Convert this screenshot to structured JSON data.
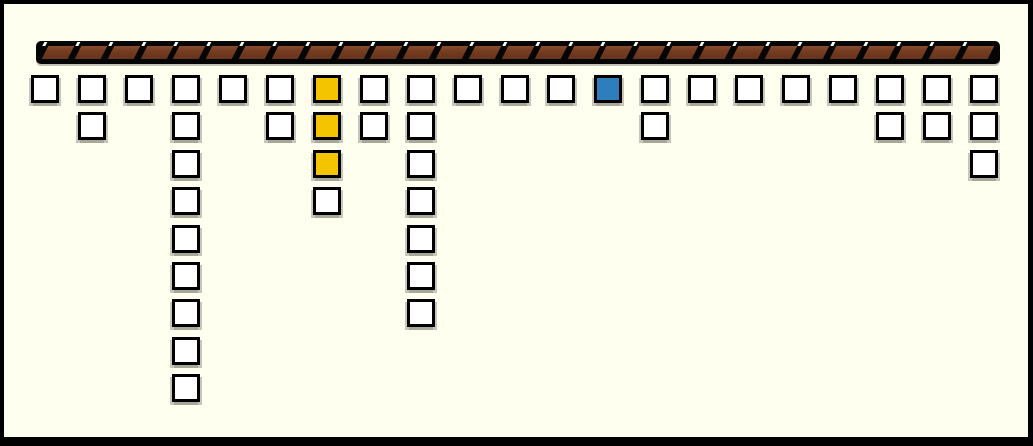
{
  "scene": {
    "background_color": "#FFFFF0",
    "frame_color": "#000000",
    "frame_border": {
      "top": 4,
      "left": 4,
      "right": 5,
      "bottom": 9
    }
  },
  "rail": {
    "segment_count": 29,
    "fill_color": "#743C20",
    "highlight_color": "#8A4C2B",
    "shadow_color": "#66341C",
    "outline_color": "#000000",
    "tick_color": "#FFFFF0"
  },
  "grid": {
    "tile_border_color": "#000000",
    "colors": {
      "white": "#FFFFFF",
      "yellow": "#F5C400",
      "blue": "#2E7EBE"
    },
    "columns": [
      {
        "cells": [
          "white"
        ]
      },
      {
        "cells": [
          "white",
          "white"
        ]
      },
      {
        "cells": [
          "white"
        ]
      },
      {
        "cells": [
          "white",
          "white",
          "white",
          "white",
          "white",
          "white",
          "white",
          "white",
          "white"
        ]
      },
      {
        "cells": [
          "white"
        ]
      },
      {
        "cells": [
          "white",
          "white"
        ]
      },
      {
        "cells": [
          "yellow",
          "yellow",
          "yellow",
          "white"
        ]
      },
      {
        "cells": [
          "white",
          "white"
        ]
      },
      {
        "cells": [
          "white",
          "white",
          "white",
          "white",
          "white",
          "white",
          "white"
        ]
      },
      {
        "cells": [
          "white"
        ]
      },
      {
        "cells": [
          "white"
        ]
      },
      {
        "cells": [
          "white"
        ]
      },
      {
        "cells": [
          "blue"
        ]
      },
      {
        "cells": [
          "white",
          "white"
        ]
      },
      {
        "cells": [
          "white"
        ]
      },
      {
        "cells": [
          "white"
        ]
      },
      {
        "cells": [
          "white"
        ]
      },
      {
        "cells": [
          "white"
        ]
      },
      {
        "cells": [
          "white",
          "white"
        ]
      },
      {
        "cells": [
          "white",
          "white"
        ]
      },
      {
        "cells": [
          "white",
          "white",
          "white"
        ]
      }
    ]
  }
}
